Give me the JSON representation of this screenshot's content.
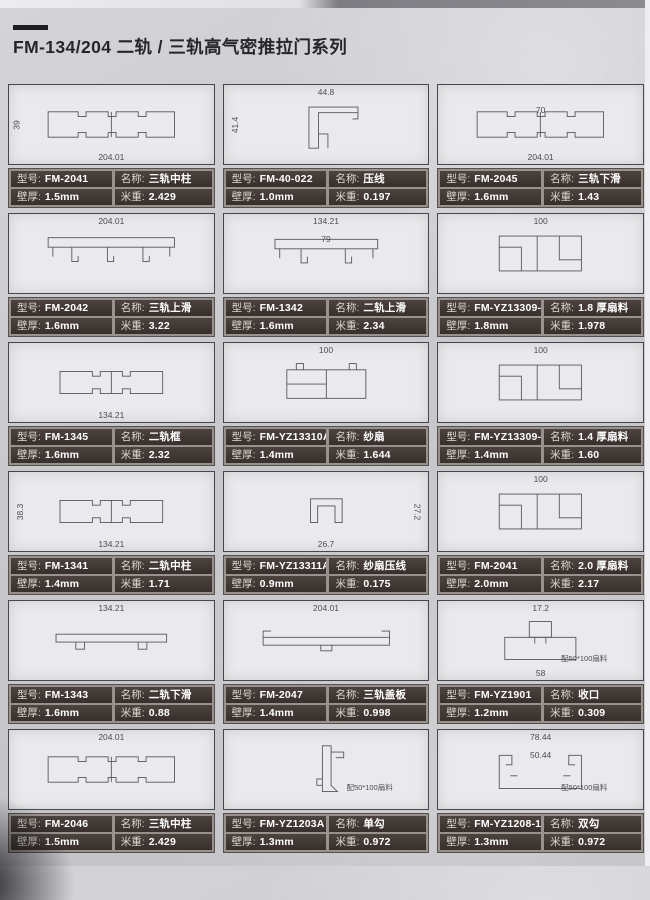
{
  "page": {
    "title": "FM-134/204 二轨 / 三轨高气密推拉门系列",
    "labels": {
      "model": "型号:",
      "name": "名称:",
      "thickness": "壁厚:",
      "weight": "米重:"
    }
  },
  "cards": [
    {
      "model": "FM-2041",
      "name": "三轨中柱",
      "thickness": "1.5mm",
      "weight": "2.429",
      "shape": "wide3",
      "dims": {
        "bottom": "204.01",
        "left": "39"
      }
    },
    {
      "model": "FM-40-022",
      "name": "压线",
      "thickness": "1.0mm",
      "weight": "0.197",
      "shape": "lpress",
      "dims": {
        "top": "44.8",
        "left": "41.4"
      }
    },
    {
      "model": "FM-2045",
      "name": "三轨下滑",
      "thickness": "1.6mm",
      "weight": "1.43",
      "shape": "wide3",
      "dims": {
        "inner": "70",
        "bottom": "204.01"
      }
    },
    {
      "model": "FM-2042",
      "name": "三轨上滑",
      "thickness": "1.6mm",
      "weight": "3.22",
      "shape": "wide3top",
      "dims": {
        "top": "204.01"
      }
    },
    {
      "model": "FM-1342",
      "name": "二轨上滑",
      "thickness": "1.6mm",
      "weight": "2.34",
      "shape": "wide2top",
      "dims": {
        "top": "134.21",
        "inner": "79"
      }
    },
    {
      "model": "FM-YZ13309-1.8",
      "name": "1.8 厚扇料",
      "thickness": "1.8mm",
      "weight": "1.978",
      "shape": "frame",
      "dims": {
        "top": "100"
      }
    },
    {
      "model": "FM-1345",
      "name": "二轨框",
      "thickness": "1.6mm",
      "weight": "2.32",
      "shape": "wide2",
      "dims": {
        "bottom": "134.21"
      }
    },
    {
      "model": "FM-YZ13310A",
      "name": "纱扇",
      "thickness": "1.4mm",
      "weight": "1.644",
      "shape": "sash",
      "dims": {
        "top": "100"
      }
    },
    {
      "model": "FM-YZ13309-1.4",
      "name": "1.4 厚扇料",
      "thickness": "1.4mm",
      "weight": "1.60",
      "shape": "frame",
      "dims": {
        "top": "100"
      }
    },
    {
      "model": "FM-1341",
      "name": "二轨中柱",
      "thickness": "1.4mm",
      "weight": "1.71",
      "shape": "wide2",
      "dims": {
        "left": "38.3",
        "bottom": "134.21"
      }
    },
    {
      "model": "FM-YZ13311A",
      "name": "纱扇压线",
      "thickness": "0.9mm",
      "weight": "0.175",
      "shape": "screenpress",
      "dims": {
        "bottom": "26.7",
        "right": "27.2"
      }
    },
    {
      "model": "FM-2041",
      "name": "2.0 厚扇料",
      "thickness": "2.0mm",
      "weight": "2.17",
      "shape": "frame",
      "dims": {
        "top": "100"
      }
    },
    {
      "model": "FM-1343",
      "name": "二轨下滑",
      "thickness": "1.6mm",
      "weight": "0.88",
      "shape": "wide2flat",
      "dims": {
        "top": "134.21"
      }
    },
    {
      "model": "FM-2047",
      "name": "三轨盖板",
      "thickness": "1.4mm",
      "weight": "0.998",
      "shape": "cover",
      "dims": {
        "top": "204.01"
      }
    },
    {
      "model": "FM-YZ1901",
      "name": "收口",
      "thickness": "1.2mm",
      "weight": "0.309",
      "shape": "tee",
      "dims": {
        "top": "17.2",
        "bottom": "58"
      },
      "note": "配50*100扇料"
    },
    {
      "model": "FM-2046",
      "name": "三轨中柱",
      "thickness": "1.5mm",
      "weight": "2.429",
      "shape": "wide3",
      "dims": {
        "top": "204.01"
      }
    },
    {
      "model": "FM-YZ1203A",
      "name": "单勾",
      "thickness": "1.3mm",
      "weight": "0.972",
      "shape": "hook1",
      "note": "配50*100扇料"
    },
    {
      "model": "FM-YZ1208-1",
      "name": "双勾",
      "thickness": "1.3mm",
      "weight": "0.972",
      "shape": "hook2",
      "dims": {
        "top": "78.44",
        "inner": "50.44"
      },
      "note": "配50*100扇料"
    }
  ]
}
